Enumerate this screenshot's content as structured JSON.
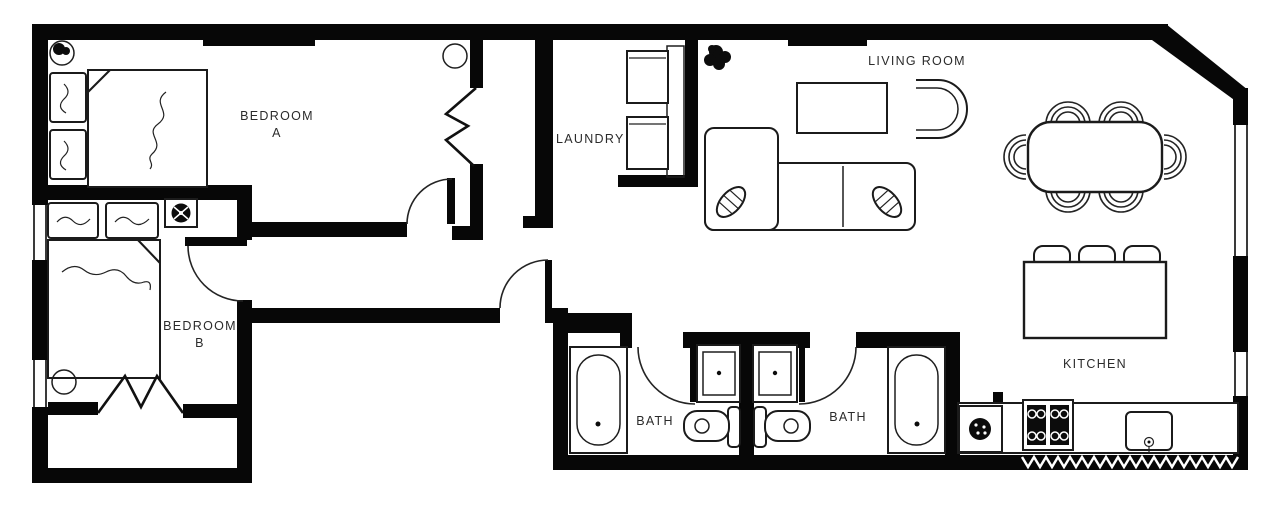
{
  "canvas": {
    "width": 1280,
    "height": 506,
    "background": "#ffffff",
    "wall_color": "#070707",
    "furniture_line_color": "#1b1b1b",
    "label_color": "#2b2b2b"
  },
  "rooms": {
    "bedroom_a": {
      "label_line1": "BEDROOM",
      "label_line2": "A"
    },
    "bedroom_b": {
      "label_line1": "BEDROOM",
      "label_line2": "B"
    },
    "laundry": {
      "label": "LAUNDRY"
    },
    "living_room": {
      "label": "LIVING ROOM"
    },
    "kitchen": {
      "label": "KITCHEN"
    },
    "bath_left": {
      "label": "BATH"
    },
    "bath_right": {
      "label": "BATH"
    }
  },
  "fixtures": [
    "double-bed",
    "pillow",
    "ceiling-light",
    "bifold-closet-door",
    "door-swing",
    "washer",
    "dryer",
    "sectional-sofa",
    "chaise",
    "coffee-table",
    "accent-chair",
    "potted-plant",
    "dining-table",
    "dining-chair",
    "kitchen-island",
    "bar-stool",
    "cooktop-range",
    "kitchen-sink",
    "garbage-disposal",
    "bathtub",
    "toilet",
    "vanity-sink",
    "window",
    "wall-fan"
  ]
}
